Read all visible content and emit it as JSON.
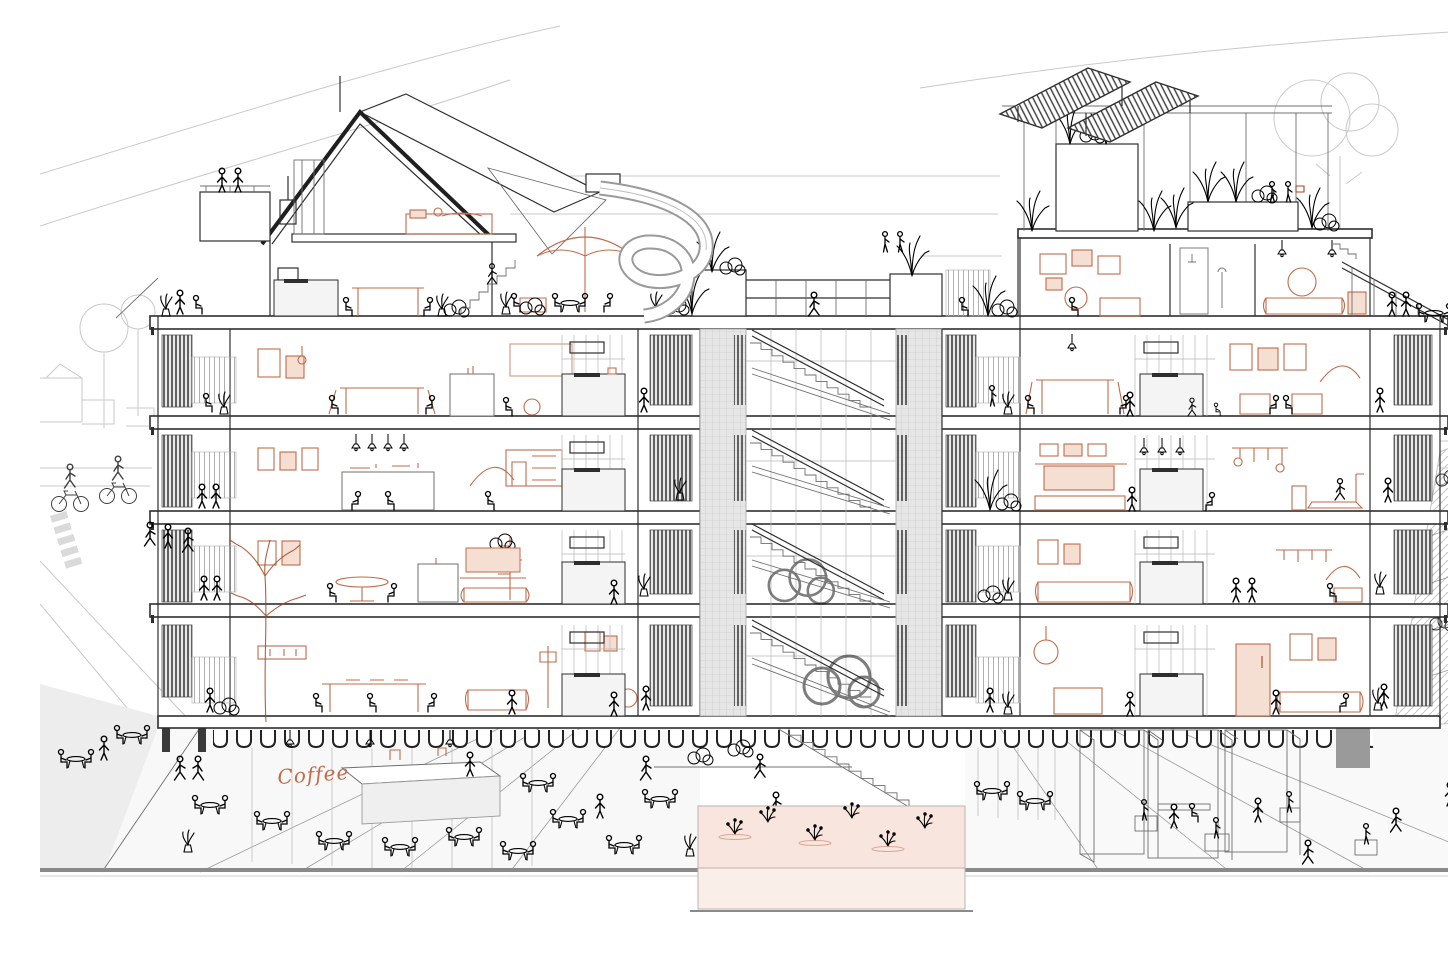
{
  "meta": {
    "title": "Cross-section illustration of a multi-storey residential building with a central stair atrium",
    "medium": "architectural line drawing, orange accents"
  },
  "signs": {
    "cafe": "Coffee"
  },
  "colors": {
    "ink": "#2e2e2e",
    "ink-mid": "#6f6f6f",
    "ink-soft": "#9a9a9a",
    "faint": "#c9c9c9",
    "accent": "#c16b4a",
    "accent-deep": "#a8441f",
    "accent-soft": "#e9c0aa",
    "wash": "#f5dfd3",
    "pond": "#f7e5de",
    "pond-face": "#faeee9",
    "panel": "#e2e2e2",
    "panel-dark": "#9a9a9a",
    "slat": "#4a4a4a",
    "ground": "#ededed",
    "ground-dark": "#dcdcdc",
    "paper": "#ffffff"
  },
  "structure": {
    "left_wing_floors": 4,
    "right_wing_floors": 5,
    "atrium_stories": 4,
    "roof_features": [
      "gable penthouse",
      "roof terrace with spiral slide",
      "roof garden",
      "solar panels"
    ],
    "ground_features": [
      "cafe colonnade",
      "plaza",
      "water garden basin",
      "wide outdoor stair"
    ]
  }
}
